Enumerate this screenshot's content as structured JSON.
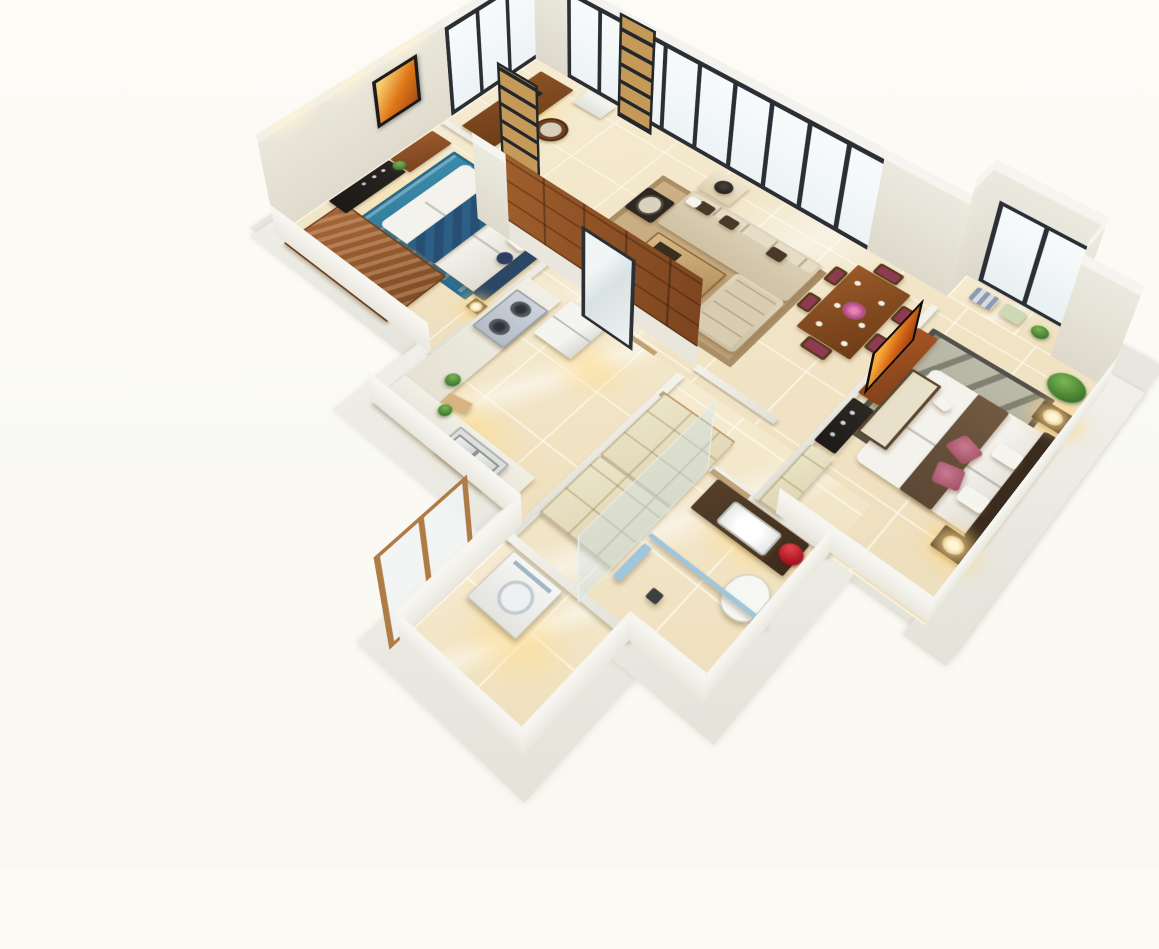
{
  "scene": {
    "description": "3D isometric cutaway floor plan render of a three-room apartment",
    "background_color": "#fbfaf4",
    "floor_color": "#f2e4c7",
    "wall_color": "#eceadf",
    "window_frame_color": "#2b2e34",
    "wood_color": "#8a4e24",
    "accent_wood_color": "#9a4f22",
    "warm_light_color": "#ffdb8c"
  },
  "rooms": [
    {
      "id": "study",
      "label": "study-corner",
      "items": [
        {
          "n": "study-desk",
          "c": "deskw",
          "b": [
            22,
            14,
            56,
            140
          ]
        },
        {
          "n": "desk-equipment",
          "c": "stuff",
          "b": [
            34,
            44,
            20,
            12
          ]
        },
        {
          "n": "study-chair",
          "c": "chair-r",
          "b": [
            86,
            66,
            36,
            36
          ]
        },
        {
          "n": "white-cabinet",
          "c": "boxw",
          "b": [
            92,
            2,
            46,
            30
          ]
        }
      ]
    },
    {
      "id": "living-room",
      "label": "living-room",
      "items": [
        {
          "n": "area-rug",
          "c": "rug-tan",
          "b": [
            258,
            58,
            215,
            158
          ]
        },
        {
          "n": "sofa",
          "c": "sofa",
          "b": [
            300,
            52,
            178,
            70
          ]
        },
        {
          "n": "chaise",
          "c": "chaise",
          "b": [
            414,
            122,
            64,
            92
          ]
        },
        {
          "n": "sofa-pillow",
          "c": "pil-br",
          "b": [
            318,
            60,
            20,
            16
          ]
        },
        {
          "n": "sofa-pillow",
          "c": "pil-br",
          "b": [
            352,
            60,
            20,
            16
          ]
        },
        {
          "n": "sofa-pillow",
          "c": "pil-br",
          "b": [
            420,
            64,
            20,
            16
          ]
        },
        {
          "n": "sofa-pillow",
          "c": "pil-w",
          "b": [
            304,
            62,
            16,
            14
          ]
        },
        {
          "n": "coffee-table",
          "c": "coffee",
          "b": [
            312,
            132,
            92,
            56
          ]
        },
        {
          "n": "armchair",
          "c": "armchair",
          "b": [
            258,
            84,
            40,
            44
          ]
        },
        {
          "n": "side-table",
          "c": "sidetab",
          "b": [
            300,
            8,
            46,
            40
          ]
        },
        {
          "n": "vase-lamp",
          "c": "vaselamp",
          "b": [
            312,
            16,
            22,
            22
          ]
        }
      ]
    },
    {
      "id": "dining",
      "label": "dining-area",
      "items": [
        {
          "n": "dining-table",
          "c": "tabled",
          "b": [
            505,
            25,
            66,
            116
          ]
        },
        {
          "n": "dining-chair",
          "c": "chair-d",
          "b": [
            488,
            42,
            16,
            26
          ]
        },
        {
          "n": "dining-chair",
          "c": "chair-d",
          "b": [
            488,
            92,
            16,
            26
          ]
        },
        {
          "n": "dining-chair",
          "c": "chair-d",
          "b": [
            572,
            42,
            16,
            26
          ]
        },
        {
          "n": "dining-chair",
          "c": "chair-d",
          "b": [
            572,
            92,
            16,
            26
          ]
        },
        {
          "n": "dining-chair",
          "c": "chair-d",
          "b": [
            522,
            6,
            30,
            18
          ]
        },
        {
          "n": "dining-chair",
          "c": "chair-d",
          "b": [
            522,
            142,
            30,
            18
          ]
        }
      ]
    },
    {
      "id": "master-bedroom",
      "label": "master-bedroom",
      "items": [
        {
          "n": "bedroom-rug",
          "c": "rug-gray",
          "b": [
            612,
            48,
            126,
            156
          ]
        },
        {
          "n": "master-bed",
          "c": "duvet",
          "b": [
            640,
            92,
            136,
            146
          ]
        },
        {
          "n": "headboard",
          "c": "headb",
          "b": [
            760,
            88,
            16,
            154
          ],
          "bg": "#3a2b1f"
        },
        {
          "n": "bed-runner",
          "c": "runner-br",
          "b": [
            690,
            92,
            34,
            146
          ]
        },
        {
          "n": "floral-pillow",
          "c": "pil-f",
          "b": [
            700,
            146,
            26,
            26
          ],
          "r": 20
        },
        {
          "n": "floral-pillow",
          "c": "pil-f",
          "b": [
            704,
            182,
            26,
            26
          ],
          "r": -14
        },
        {
          "n": "bed-pillow",
          "c": "pil-w",
          "b": [
            734,
            128,
            26,
            20
          ]
        },
        {
          "n": "bed-pillow",
          "c": "pil-w",
          "b": [
            734,
            192,
            26,
            20
          ]
        },
        {
          "n": "magazines",
          "c": "pil-w",
          "b": [
            660,
            120,
            18,
            12
          ],
          "r": 12
        },
        {
          "n": "nightstand",
          "c": "nstand",
          "b": [
            742,
            54,
            32,
            28
          ]
        },
        {
          "n": "table-lamp",
          "c": "lamp",
          "b": [
            748,
            58,
            20,
            20
          ]
        },
        {
          "n": "nightstand",
          "c": "nstand",
          "b": [
            742,
            242,
            32,
            28
          ]
        },
        {
          "n": "table-lamp",
          "c": "lamp",
          "b": [
            748,
            246,
            20,
            20
          ]
        },
        {
          "n": "bench",
          "c": "bench",
          "b": [
            624,
            108,
            28,
            96
          ]
        },
        {
          "n": "potted-plant",
          "c": "plant",
          "b": [
            732,
            8,
            38,
            36
          ]
        },
        {
          "n": "tv-sideboard",
          "c": "consr",
          "b": [
            600,
            58,
            24,
            112
          ]
        },
        {
          "n": "media-console",
          "c": "consb",
          "b": [
            600,
            178,
            24,
            68
          ]
        },
        {
          "n": "wardrobe",
          "c": "cab",
          "b": [
            600,
            252,
            26,
            84
          ]
        },
        {
          "n": "bay-cushion",
          "c": "baycush1",
          "b": [
            618,
            -34,
            26,
            22
          ]
        },
        {
          "n": "bay-cushion",
          "c": "baycush2",
          "b": [
            652,
            -34,
            24,
            20
          ]
        },
        {
          "n": "bay-plant",
          "c": "plant",
          "b": [
            688,
            -30,
            18,
            18
          ]
        }
      ]
    },
    {
      "id": "bedroom-2",
      "label": "second-bedroom",
      "items": [
        {
          "n": "bedroom-rug",
          "c": "rug-teal",
          "b": [
            48,
            192,
            168,
            146
          ]
        },
        {
          "n": "bed",
          "c": "duvet",
          "b": [
            72,
            198,
            158,
            134
          ]
        },
        {
          "n": "headboard",
          "c": "headb",
          "b": [
            222,
            194,
            18,
            140
          ],
          "bg": "#2a4766"
        },
        {
          "n": "blue-quilt",
          "c": "quilt",
          "b": [
            118,
            198,
            44,
            134
          ]
        },
        {
          "n": "bed-pillow",
          "c": "pil-w",
          "b": [
            194,
            214,
            26,
            18
          ],
          "r": -10
        },
        {
          "n": "bed-pillow",
          "c": "pil-w",
          "b": [
            196,
            240,
            24,
            16
          ],
          "r": 6
        },
        {
          "n": "round-pillow",
          "c": "pil-n",
          "b": [
            204,
            266,
            18,
            18
          ]
        },
        {
          "n": "nightstand",
          "c": "nstand",
          "b": [
            230,
            178,
            18,
            16
          ]
        },
        {
          "n": "table-lamp",
          "c": "lamp",
          "b": [
            232,
            180,
            14,
            14
          ]
        },
        {
          "n": "nightstand",
          "c": "nstand",
          "b": [
            230,
            336,
            18,
            16
          ]
        },
        {
          "n": "table-lamp",
          "c": "lamp",
          "b": [
            232,
            338,
            14,
            14
          ]
        },
        {
          "n": "wardrobe-top",
          "c": "wardslab",
          "b": [
            16,
            336,
            165,
            82
          ]
        },
        {
          "n": "black-dresser",
          "c": "dresser",
          "b": [
            2,
            254,
            30,
            92
          ]
        },
        {
          "n": "wood-sideboard",
          "c": "sidewood",
          "b": [
            2,
            184,
            34,
            68
          ]
        },
        {
          "n": "sideboard-plant",
          "c": "plant",
          "b": [
            10,
            244,
            16,
            16
          ]
        }
      ]
    },
    {
      "id": "kitchen",
      "label": "kitchen",
      "items": [
        {
          "n": "counter-west",
          "c": "counter",
          "b": [
            250,
            278,
            50,
            200
          ]
        },
        {
          "n": "gas-cooktop",
          "c": "cooktop",
          "b": [
            254,
            298,
            42,
            64
          ]
        },
        {
          "n": "counter-south",
          "c": "counter",
          "b": [
            250,
            456,
            180,
            44
          ]
        },
        {
          "n": "double-sink",
          "c": "sink2",
          "b": [
            336,
            462,
            62,
            32
          ]
        },
        {
          "n": "refrigerator",
          "c": "fridge",
          "b": [
            308,
            272,
            52,
            58
          ]
        },
        {
          "n": "cutting-board",
          "c": "board",
          "b": [
            300,
            438,
            28,
            14
          ],
          "r": -12
        },
        {
          "n": "counter-plant",
          "c": "plant",
          "b": [
            282,
            420,
            16,
            16
          ]
        },
        {
          "n": "counter-plant",
          "c": "plant",
          "b": [
            304,
            452,
            14,
            14
          ]
        }
      ]
    },
    {
      "id": "hallway",
      "label": "entry-hall",
      "items": [
        {
          "n": "wardrobe-cabinet",
          "c": "cab",
          "b": [
            458,
            300,
            86,
            96
          ]
        },
        {
          "n": "shoe-cabinet",
          "c": "cab",
          "b": [
            458,
            398,
            86,
            82
          ]
        }
      ]
    },
    {
      "id": "bathroom",
      "label": "master-bathroom",
      "items": [
        {
          "n": "vanity",
          "c": "vanity",
          "b": [
            558,
            342,
            104,
            42
          ]
        },
        {
          "n": "vanity-sink",
          "c": "sink1",
          "b": [
            584,
            350,
            50,
            26
          ]
        },
        {
          "n": "rose-bouquet",
          "c": "roses",
          "b": [
            644,
            350,
            22,
            22
          ]
        },
        {
          "n": "toilet",
          "c": "toilet",
          "b": [
            630,
            398,
            38,
            46
          ]
        },
        {
          "n": "shower-glass-line",
          "c": "towel",
          "b": [
            548,
            428,
            130,
            5
          ]
        },
        {
          "n": "towel-bar",
          "c": "towel",
          "b": [
            550,
            440,
            9,
            44
          ]
        },
        {
          "n": "floor-drain",
          "c": "drain",
          "b": [
            584,
            468,
            12,
            12
          ]
        }
      ]
    },
    {
      "id": "laundry",
      "label": "laundry-balcony",
      "items": [
        {
          "n": "washing-machine",
          "c": "washer",
          "b": [
            468,
            524,
            58,
            58
          ]
        }
      ]
    }
  ]
}
